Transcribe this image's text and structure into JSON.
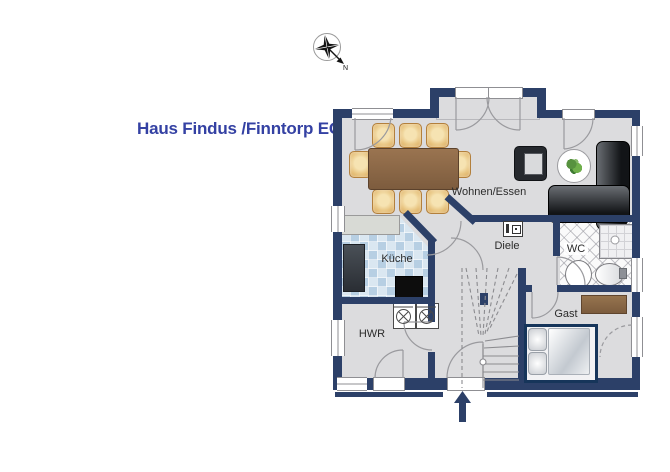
{
  "title": "Haus Findus /Finntorp EG",
  "compass": {
    "direction_label": "N"
  },
  "rooms": {
    "wohnen_essen": {
      "label": "Wohnen/Essen"
    },
    "kueche": {
      "label": "Küche"
    },
    "diele": {
      "label": "Diele"
    },
    "wc": {
      "label": "WC"
    },
    "hwr": {
      "label": "HWR"
    },
    "gast": {
      "label": "Gast"
    }
  },
  "furniture": {
    "dining_table": "dining table",
    "dining_chairs": 8,
    "armchair": "armchair",
    "side_table_with_plant": "round side table with plant",
    "corner_sofa": "L-shaped corner sofa",
    "kitchen_counter": "kitchen counter",
    "refrigerator": "refrigerator",
    "stove": "stove",
    "washing_machines": 2,
    "staircase": "winder staircase",
    "bed": "double bed",
    "sideboard": "sideboard",
    "shower": "shower",
    "toilet": "toilet",
    "washbasin": "washbasin",
    "vent_shaft": "ventilation shaft",
    "entrance_arrow": "entrance direction arrow"
  },
  "colors": {
    "wall": "#2c4068",
    "title": "#3441a3",
    "floor": "#dcdcde",
    "tile_blue": "#b7cfe3",
    "wood_brown": "#8a6a4a",
    "chair_tan": "#e8c98e",
    "bed_frame": "#16355a"
  }
}
